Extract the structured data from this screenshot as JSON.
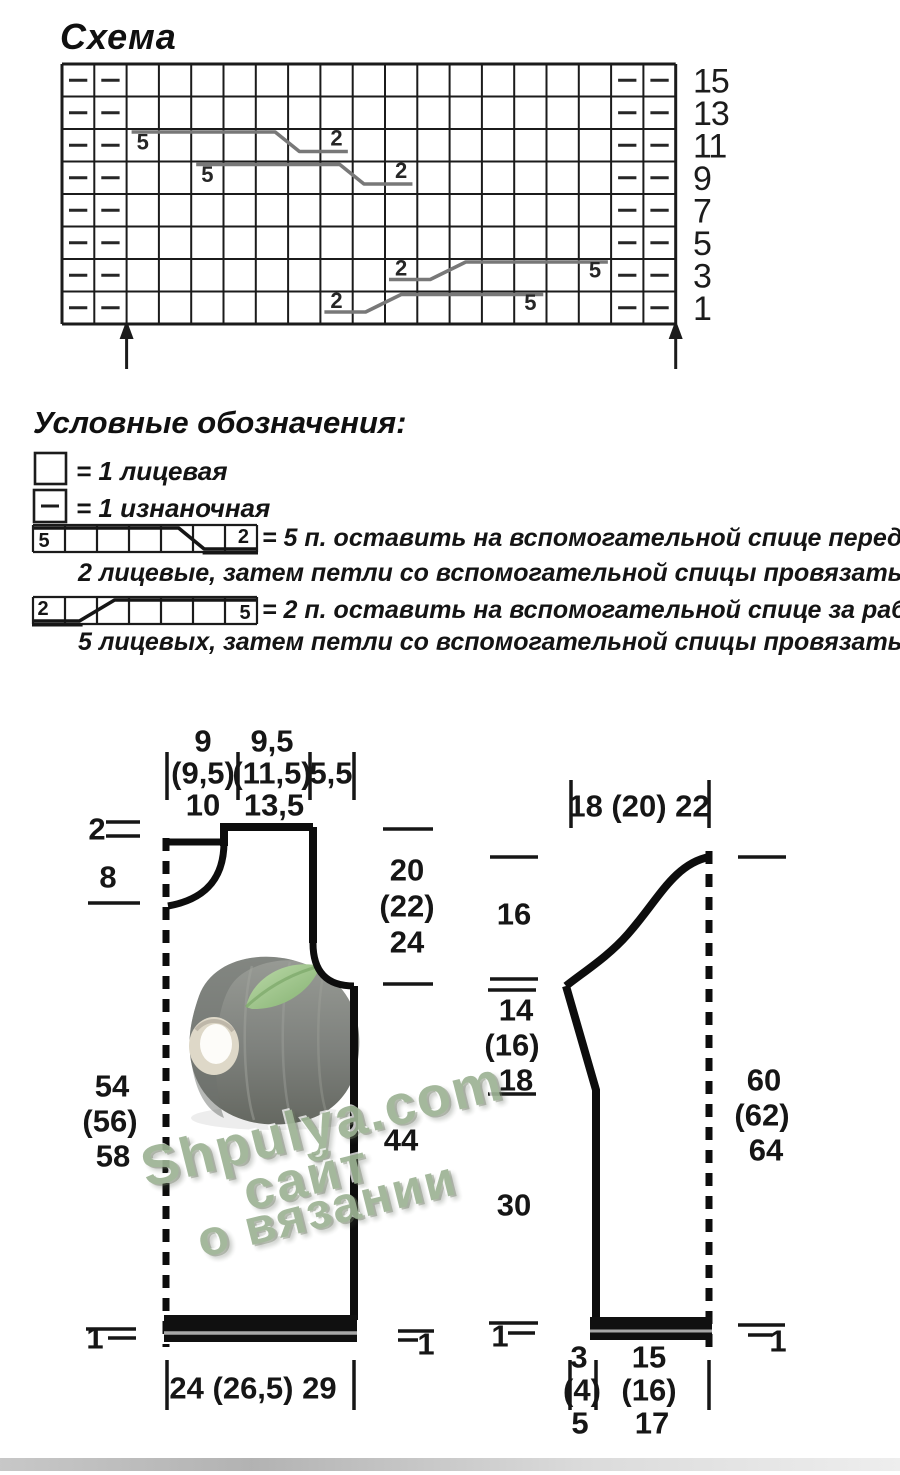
{
  "page": {
    "width": 900,
    "height": 1475,
    "background": "#ffffff"
  },
  "chart": {
    "title": "Схема",
    "columns": 19,
    "rows": 8,
    "row_labels": [
      "15",
      "13",
      "11",
      "9",
      "7",
      "5",
      "3",
      "1"
    ],
    "purl_left_cols": [
      1,
      2
    ],
    "purl_right_cols": [
      18,
      19
    ],
    "cables": [
      {
        "row": 3,
        "type": "front",
        "start_col": 3,
        "label_five": "5",
        "label_two": "2"
      },
      {
        "row": 4,
        "type": "front",
        "start_col": 5,
        "label_five": "5",
        "label_two": "2"
      },
      {
        "row": 7,
        "type": "back",
        "start_col": 11,
        "label_five": "5",
        "label_two": "2"
      },
      {
        "row": 8,
        "type": "back",
        "start_col": 9,
        "label_five": "5",
        "label_two": "2"
      }
    ],
    "arrow_cols": [
      2,
      19
    ]
  },
  "legend": {
    "title": "Условные обозначения:",
    "items": [
      {
        "symbol": "knit",
        "text": "= 1 лицевая"
      },
      {
        "symbol": "purl",
        "text": "= 1 изнаночная"
      },
      {
        "symbol": "cable-front",
        "label_left": "5",
        "label_right": "2",
        "text": "= 5 п. оставить на вспомогательной спице перед работой,",
        "text2": "2 лицевые, затем петли со вспомогательной спицы провязать лицевыми"
      },
      {
        "symbol": "cable-back",
        "label_left": "2",
        "label_right": "5",
        "text": "= 2 п. оставить на вспомогательной спице за работой,",
        "text2": "5 лицевых, затем петли со вспомогательной спицы провязать лицевыми"
      }
    ]
  },
  "schematics": {
    "body": {
      "top_sections": [
        [
          "9",
          "(9,5)",
          "10"
        ],
        [
          "9,5",
          "(11,5)",
          "13,5"
        ],
        [
          "5,5"
        ]
      ],
      "neck_back_depth": "2",
      "neck_front_depth": "8",
      "side_length": [
        "54",
        "(56)",
        "58"
      ],
      "armhole_depth": [
        "20",
        "(22)",
        "24"
      ],
      "upper_side": "44",
      "hem_left": "1",
      "hem_right": "1",
      "bottom_width": "24 (26,5) 29"
    },
    "sleeve": {
      "top_width": "18 (20) 22",
      "cap_height": "16",
      "slope_height": [
        "14",
        "(16)",
        "18"
      ],
      "lower_height": "30",
      "total_length": [
        "60",
        "(62)",
        "64"
      ],
      "hem_left": "1",
      "hem_right": "1",
      "bottom_inc": [
        "3",
        "(4)",
        "5"
      ],
      "bottom_width": [
        "15",
        "(16)",
        "17"
      ]
    }
  },
  "watermark": {
    "line1": "Shpulya.com",
    "line2": "сайт",
    "line3": "о вязании",
    "color": "#9db394"
  },
  "colors": {
    "ink": "#161616",
    "cable_line": "#787878",
    "cone_grey": "#7e817d",
    "leaf_green": "#9cc489"
  }
}
